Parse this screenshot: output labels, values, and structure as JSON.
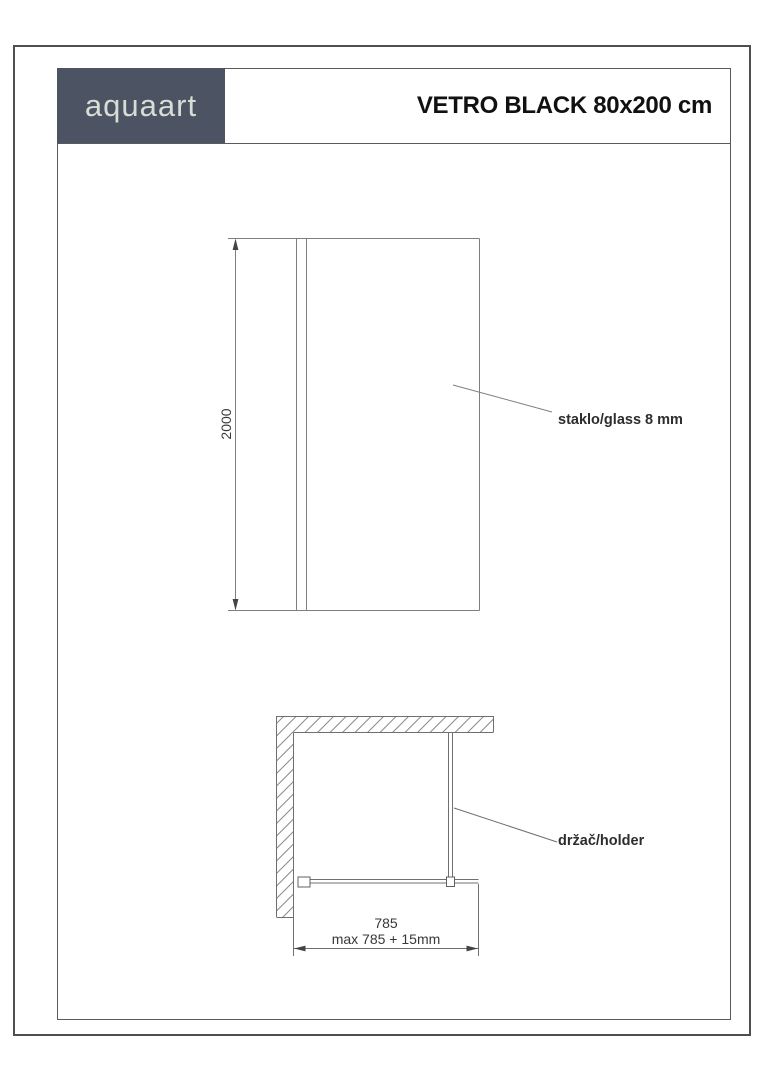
{
  "header": {
    "logo_text": "aquaart",
    "title": "VETRO BLACK 80x200 cm"
  },
  "front_view": {
    "height_dimension": "2000",
    "glass_label": "staklo/glass 8 mm"
  },
  "top_view": {
    "holder_label": "držač/holder",
    "width_dimension": "785",
    "max_width_note": "max 785 + 15mm"
  },
  "colors": {
    "logo_background": "#4c5362",
    "logo_text": "#d7dcd4",
    "frame_border": "#5a5a5a",
    "drawing_line": "#7f7f7f",
    "arrow_fill": "#444444",
    "dimension_text": "#383838",
    "label_text": "#2d2d2d",
    "title_text": "#111111"
  }
}
